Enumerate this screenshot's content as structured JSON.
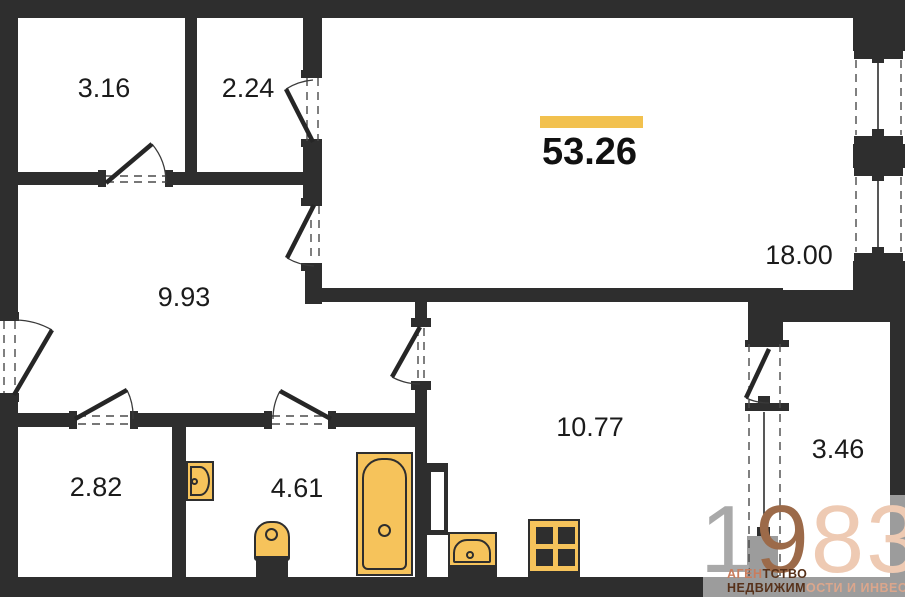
{
  "plan": {
    "title": "apartment-floor-plan",
    "total_area": {
      "value": "53.26"
    },
    "rooms": [
      {
        "key": "storage-1",
        "area": "3.16"
      },
      {
        "key": "storage-2",
        "area": "2.24"
      },
      {
        "key": "living-room",
        "area": "18.00"
      },
      {
        "key": "hallway",
        "area": "9.93"
      },
      {
        "key": "wardrobe",
        "area": "2.82"
      },
      {
        "key": "bathroom",
        "area": "4.61"
      },
      {
        "key": "kitchen",
        "area": "10.77"
      },
      {
        "key": "balcony",
        "area": "3.46"
      }
    ],
    "fixtures": [
      "bathtub",
      "toilet",
      "washbasin",
      "kitchen-sink",
      "stove",
      "ventilation-shaft"
    ],
    "colors": {
      "wall": "#2e2e2e",
      "exterior_wall": "#9c9c9c",
      "fixture": "#f6c35b",
      "accent": "#f2c14e"
    }
  },
  "watermark": {
    "digits": [
      {
        "text": "1",
        "color": "#a9a9a9"
      },
      {
        "text": "9",
        "color": "#9c6a49"
      },
      {
        "text": "8",
        "color": "#eecab3"
      },
      {
        "text": "3",
        "color": "#eecab3"
      }
    ],
    "line1_left": "АГЕН",
    "line1_right": "ТСТВО",
    "line2_left": "НЕДВИЖИМ",
    "line2_right": "ОСТИ И ИНВЕСТИЦИЙ",
    "line1_left_color": "#c97d5d",
    "line1_right_color": "#57311a",
    "line2_left_color": "#57311a",
    "line2_right_color": "#dba68c"
  }
}
